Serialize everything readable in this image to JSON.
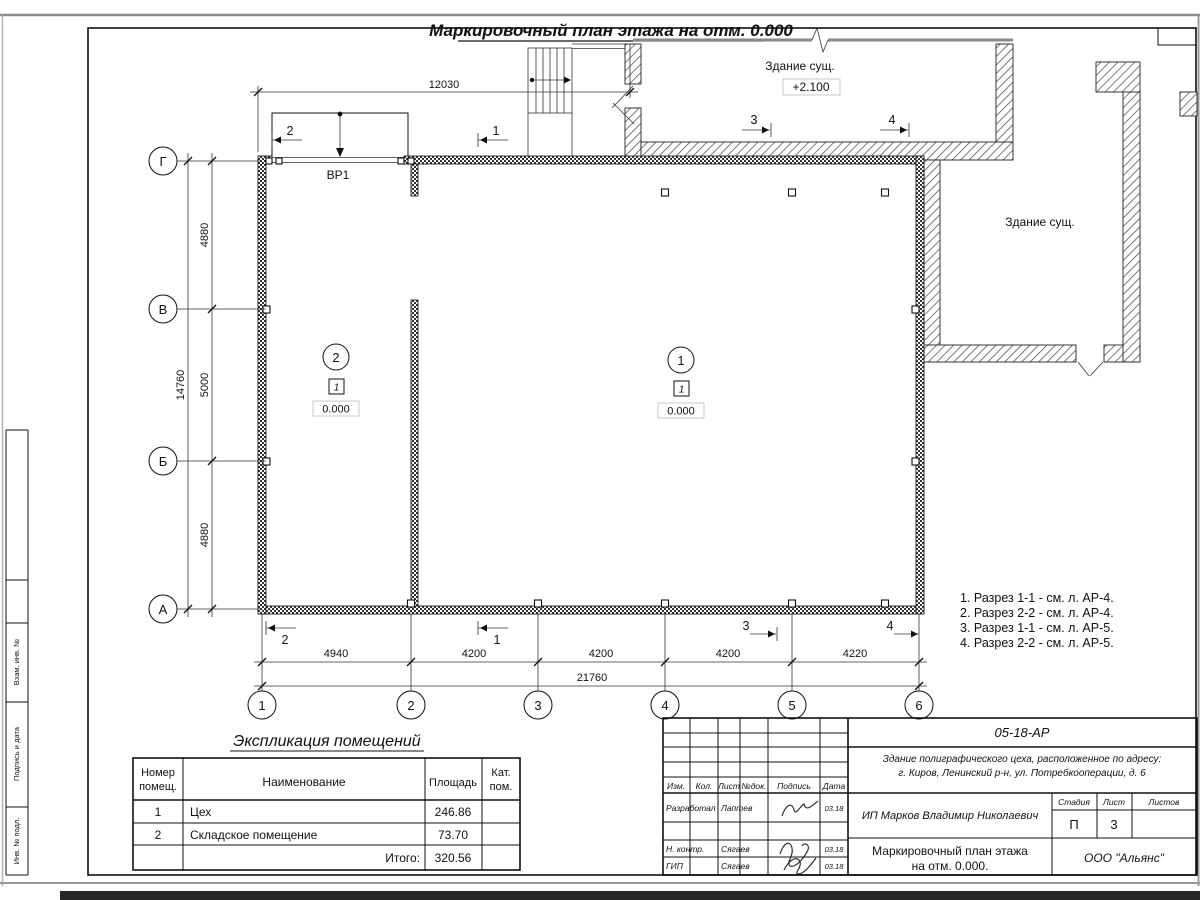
{
  "sheet": {
    "title": "Маркировочный план этажа на отм. 0.000",
    "side_labels": [
      "Взам. инв. №",
      "Подпись и дата",
      "Инв. № подл."
    ]
  },
  "plan": {
    "axes_horizontal": [
      "Г",
      "В",
      "Б",
      "А"
    ],
    "axes_vertical": [
      "1",
      "2",
      "3",
      "4",
      "5",
      "6"
    ],
    "dim_top": "12030",
    "dims_left": [
      "4880",
      "5000",
      "4880"
    ],
    "dim_left_total": "14760",
    "dims_bottom": [
      "4940",
      "4200",
      "4200",
      "4200",
      "4220"
    ],
    "dim_bottom_total": "21760",
    "gate_label": "ВР1",
    "existing_top": {
      "label": "Здание сущ.",
      "level": "+2.100"
    },
    "existing_right": {
      "label": "Здание сущ."
    },
    "rooms": [
      {
        "number": "1",
        "tag": "1",
        "level": "0.000"
      },
      {
        "number": "2",
        "tag": "1",
        "level": "0.000"
      }
    ],
    "sections_top": [
      "2",
      "1",
      "3",
      "4"
    ],
    "sections_bottom": [
      "2",
      "1",
      "3",
      "4"
    ],
    "notes": [
      "1. Разрез 1-1 - см. л. АР-4.",
      "2. Разрез 2-2 - см. л. АР-4.",
      "3. Разрез 1-1 - см. л. АР-5.",
      "4. Разрез 2-2 - см. л. АР-5."
    ]
  },
  "explication": {
    "title": "Экспликация помещений",
    "col_num_line1": "Номер",
    "col_num_line2": "помещ.",
    "col_name": "Наименование",
    "col_area": "Площадь",
    "col_cat_line1": "Кат.",
    "col_cat_line2": "пом.",
    "rows": [
      {
        "num": "1",
        "name": "Цех",
        "area": "246.86",
        "cat": ""
      },
      {
        "num": "2",
        "name": "Складское помещение",
        "area": "73.70",
        "cat": ""
      }
    ],
    "total_label": "Итого:",
    "total_value": "320.56"
  },
  "titleblock": {
    "doc_number": "05-18-АР",
    "description_line1": "Здание полиграфического цеха, расположенное по адресу:",
    "description_line2": "г. Киров,  Ленинский р-н, ул. Потребкооперации, д. 6",
    "client": "ИП Марков Владимир Николаевич",
    "cols": [
      "Изм.",
      "Кол.",
      "Лист",
      "№док.",
      "Подпись",
      "Дата"
    ],
    "rows": [
      {
        "role": "Разработал",
        "name": "Лаптев",
        "date": "03.18"
      },
      {
        "role": "Н. контр.",
        "name": "Сягаев",
        "date": "03.18"
      },
      {
        "role": "ГИП",
        "name": "Сягаев",
        "date": "03.18"
      }
    ],
    "stage_label": "Стадия",
    "sheet_label": "Лист",
    "sheets_label": "Листов",
    "stage": "П",
    "sheet_no": "3",
    "sheets_total": "",
    "drawing_title_line1": "Маркировочный план этажа",
    "drawing_title_line2": "на отм. 0.000.",
    "company": "ООО \"Альянс\""
  }
}
